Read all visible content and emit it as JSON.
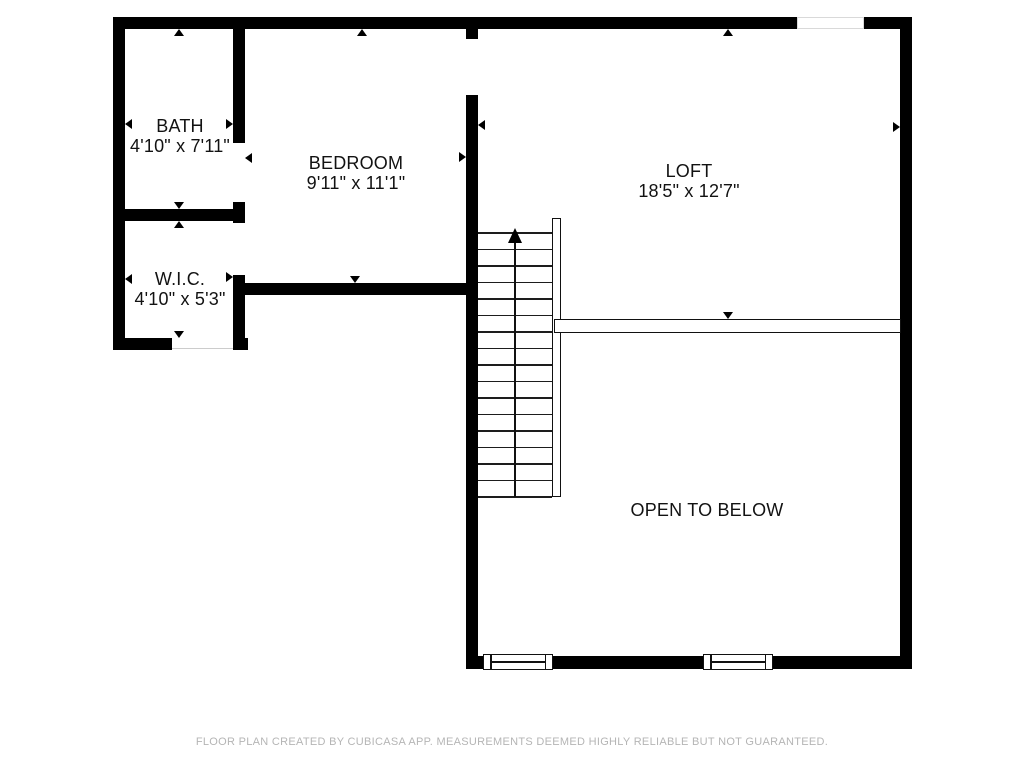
{
  "rooms": [
    {
      "name": "BATH",
      "dimensions": "4'10\" x 7'11\""
    },
    {
      "name": "BEDROOM",
      "dimensions": "9'11\" x 11'1\""
    },
    {
      "name": "LOFT",
      "dimensions": "18'5\" x 12'7\""
    },
    {
      "name": "W.I.C.",
      "dimensions": "4'10\" x 5'3\""
    },
    {
      "name": "OPEN TO BELOW",
      "dimensions": ""
    }
  ],
  "stairs": {
    "steps": 16,
    "direction": "up"
  },
  "footer": {
    "disclaimer": "FLOOR PLAN CREATED BY CUBICASA APP. MEASUREMENTS DEEMED HIGHLY RELIABLE BUT NOT GUARANTEED."
  },
  "colors": {
    "wall": "#000000",
    "background": "#ffffff",
    "room_text": "#121212",
    "footer_text": "#b5b5b5"
  }
}
